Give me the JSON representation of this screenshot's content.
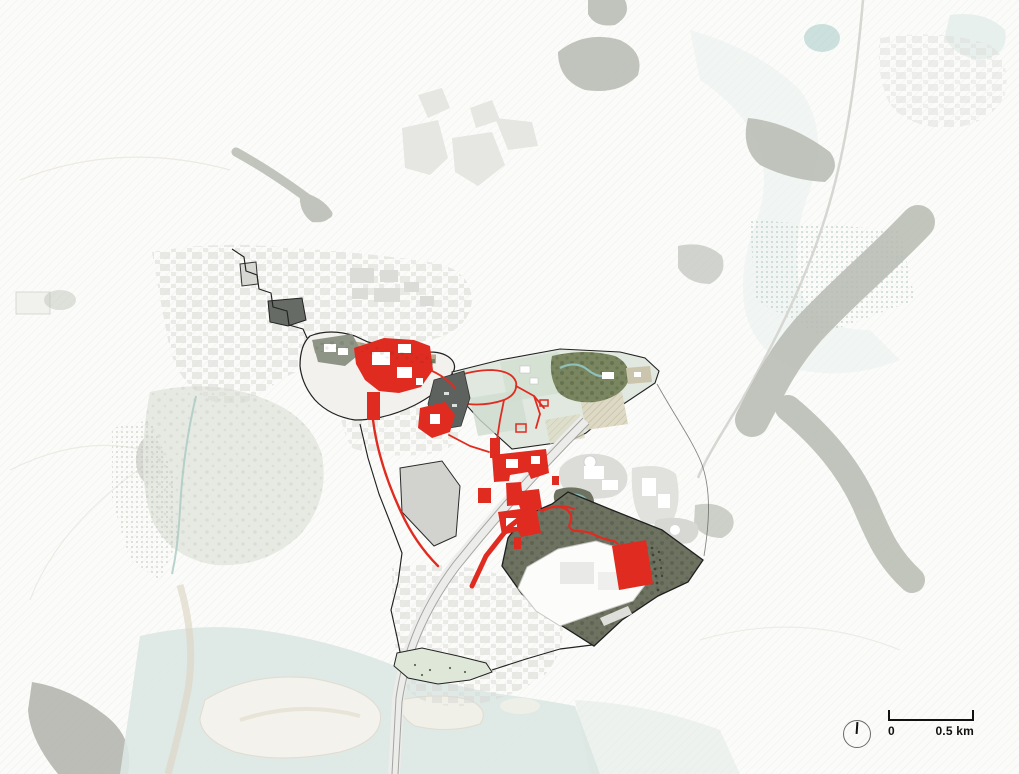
{
  "scale_bar": {
    "start_label": "0",
    "end_label": "0.5 km"
  },
  "north_indicator": {
    "icon": "north-arrow-icon"
  },
  "colors": {
    "highlight_red": "#e02b20",
    "site_outline": "#222222",
    "forest_gray": "#b7bbb2",
    "dark_site_green": "#6e7361",
    "park_green": "#e0e8df",
    "forest_green": "#79865f",
    "water_teal": "#dbe7e3",
    "pond_teal": "#87b9b6",
    "town_gray": "#d9d9d5",
    "sand": "#ddd6c4",
    "ink": "#111111"
  }
}
